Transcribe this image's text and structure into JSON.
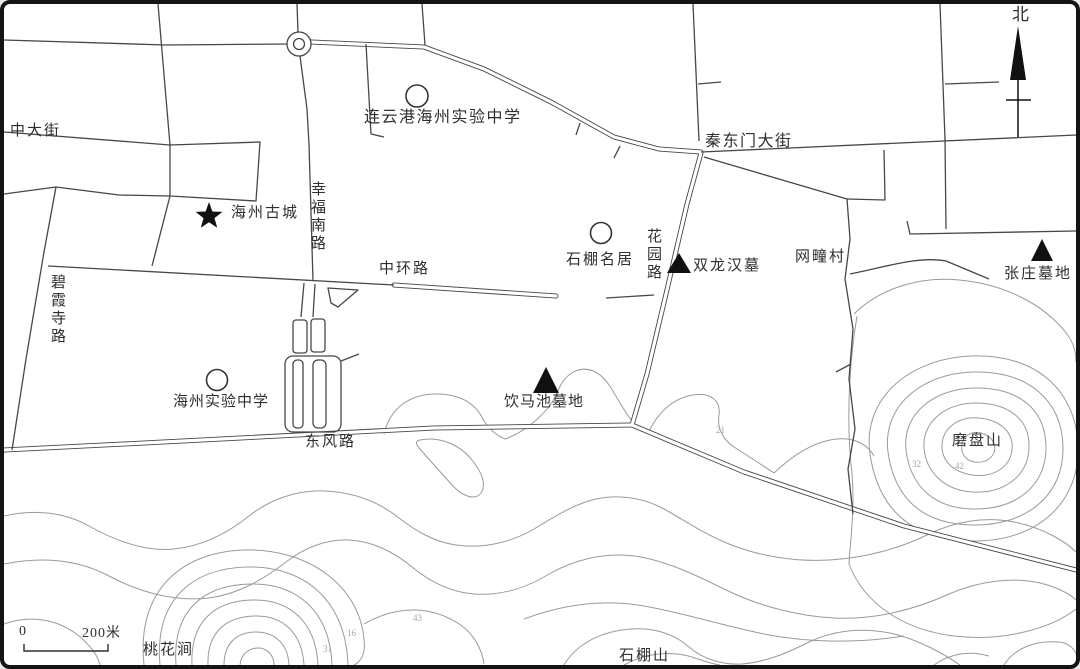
{
  "map": {
    "region_labels": {
      "zhongdajie": "中大街",
      "lyg_school": "连云港海州实验中学",
      "qindongmen": "秦东门大街",
      "haizhou_gucheng": "海州古城",
      "xingfunanlu": "幸福南路",
      "zhonghuanlu": "中环路",
      "shipengmingju": "石棚名居",
      "huayuanlu": "花园路",
      "shuanglonghanmu": "双龙汉墓",
      "wangtuancun": "网疃村",
      "zhangzhuangmudi": "张庄墓地",
      "bixiasilu": "碧霞寺路",
      "haizhou_school": "海州实验中学",
      "yinmachimudi": "饮马池墓地",
      "dongfenglu": "东风路",
      "mopanshan": "磨盘山",
      "taohuajian": "桃花涧",
      "shipengshan": "石棚山"
    },
    "north_label": "北",
    "scale_bar": {
      "zero": "0",
      "distance": "200米"
    },
    "elevation_marks": [
      "21",
      "32",
      "42",
      "43",
      "16",
      "31"
    ],
    "colors": {
      "road": "#474747",
      "contour": "#9a9a9a",
      "text": "#2f2f2f",
      "marker": "#111111",
      "background": "#ffffff",
      "border": "#141414"
    }
  }
}
